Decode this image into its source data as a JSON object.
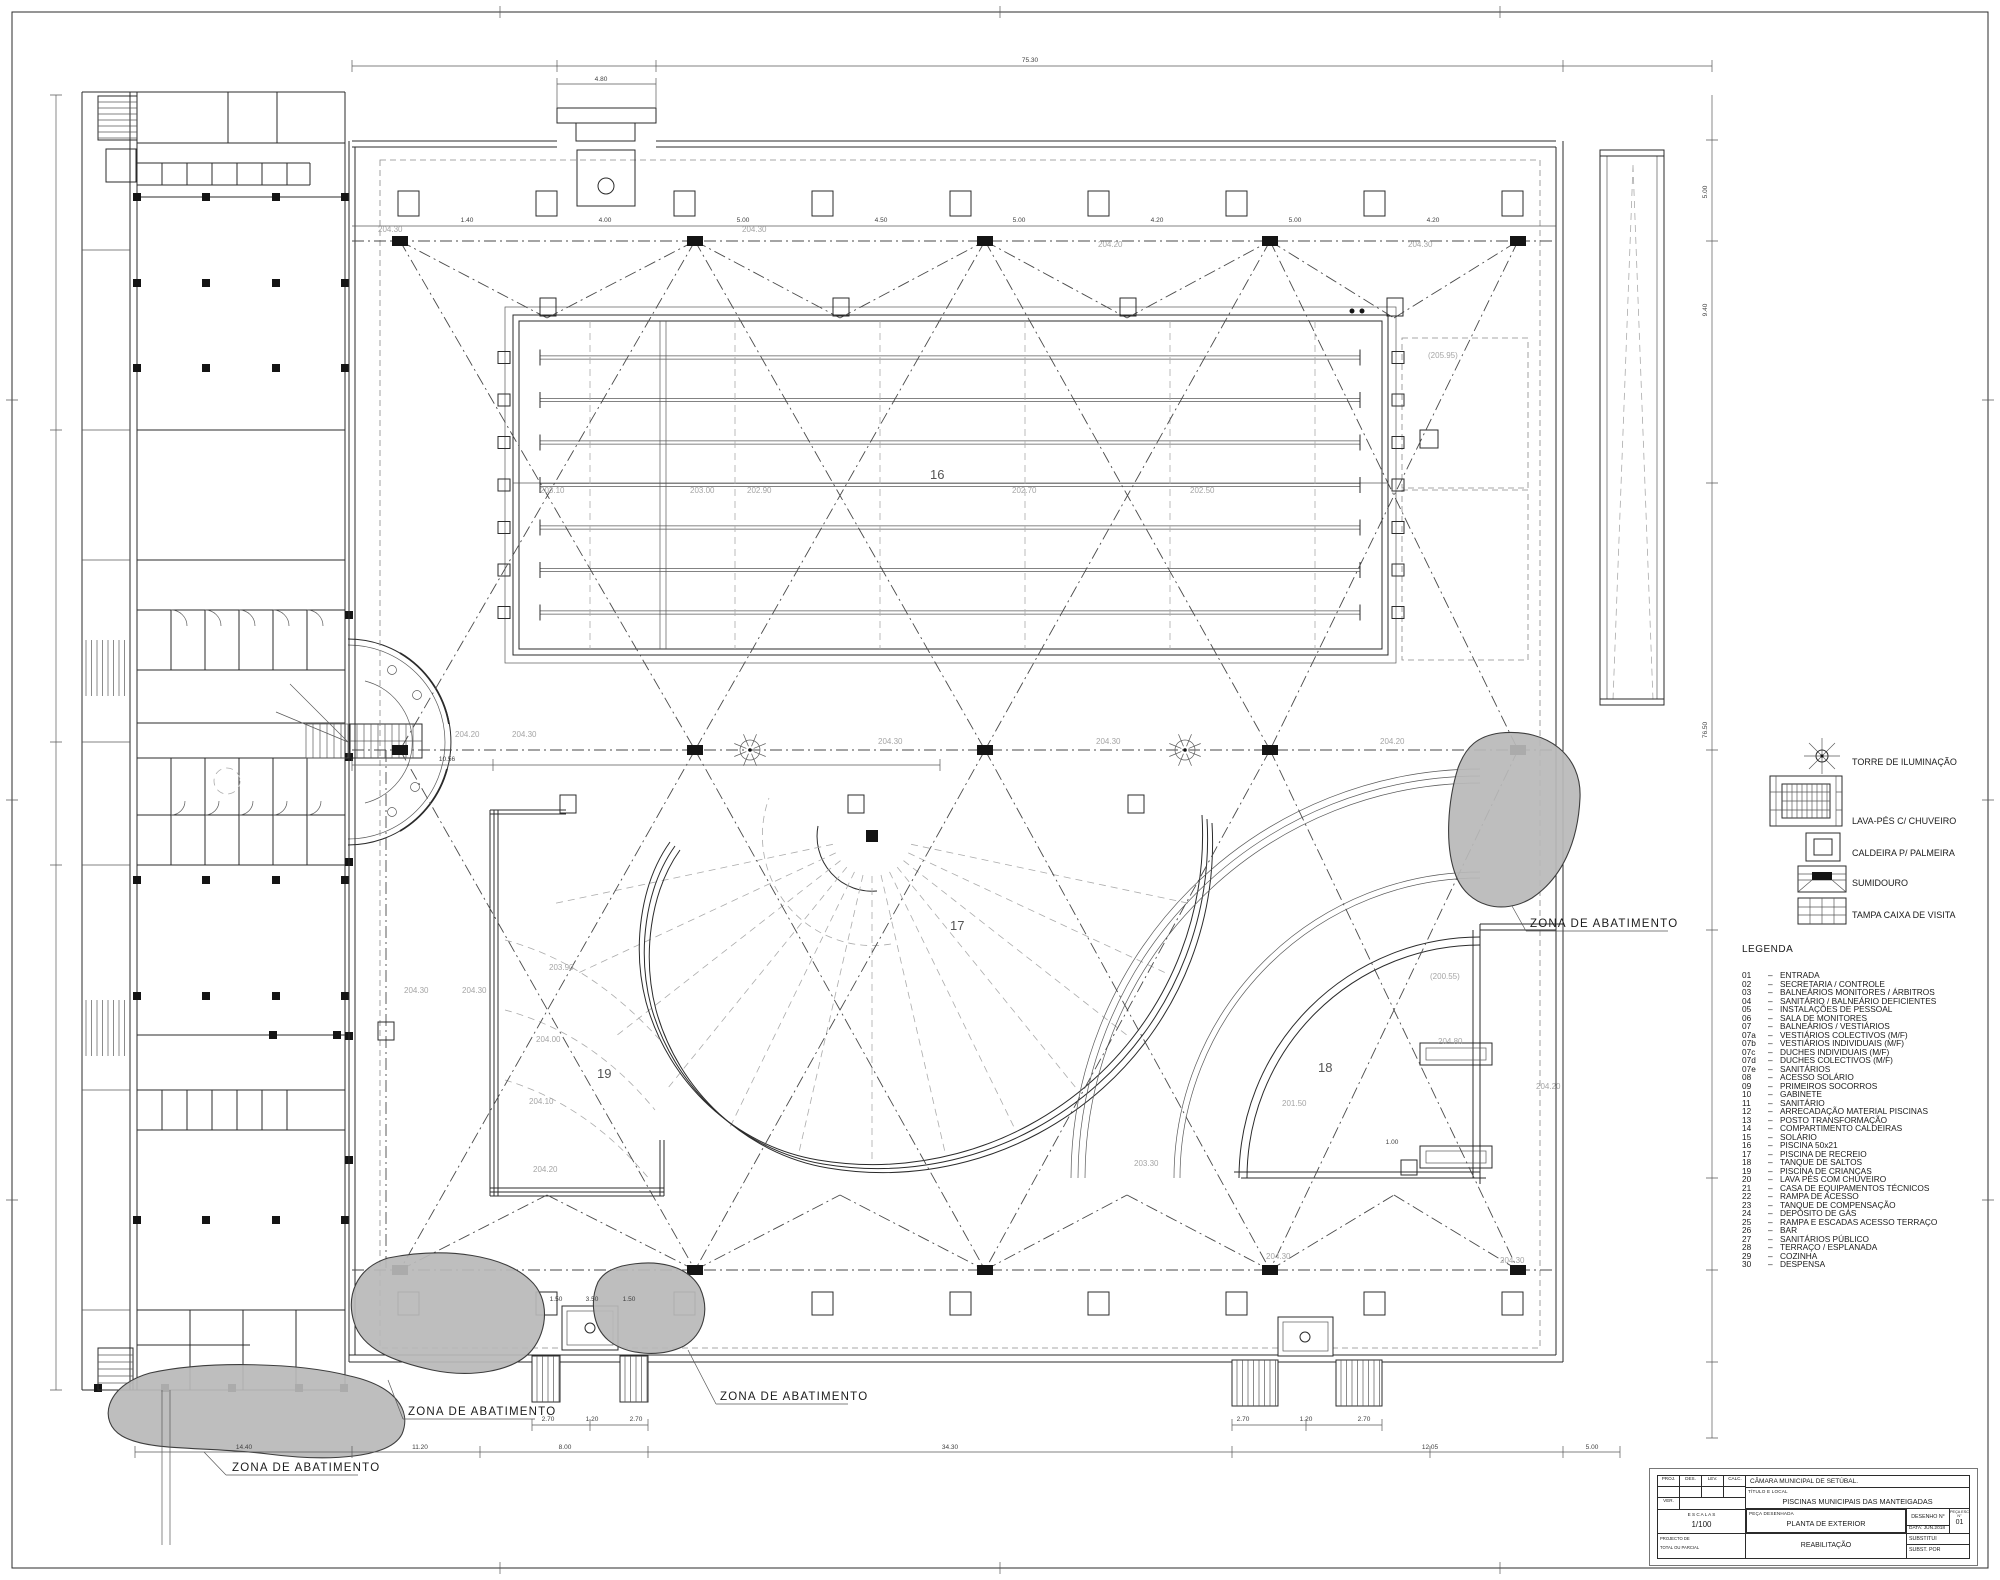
{
  "sheet": {
    "background": "#ffffff",
    "line_color": "#2b2b2b",
    "gray_text": "#a5a5a5",
    "blob_color": "#b9b9b9"
  },
  "zone_labels": [
    {
      "text": "ZONA DE ABATIMENTO",
      "x": 232,
      "y": 1471
    },
    {
      "text": "ZONA DE ABATIMENTO",
      "x": 408,
      "y": 1415
    },
    {
      "text": "ZONA DE ABATIMENTO",
      "x": 720,
      "y": 1400
    },
    {
      "text": "ZONA DE ABATIMENTO",
      "x": 1530,
      "y": 927
    }
  ],
  "area_labels": [
    {
      "text": "16",
      "x": 930,
      "y": 479
    },
    {
      "text": "17",
      "x": 950,
      "y": 930
    },
    {
      "text": "18",
      "x": 1318,
      "y": 1072
    },
    {
      "text": "19",
      "x": 597,
      "y": 1078
    }
  ],
  "elevation_labels": [
    {
      "text": "204.30",
      "x": 378,
      "y": 232
    },
    {
      "text": "204.30",
      "x": 742,
      "y": 232
    },
    {
      "text": "204.20",
      "x": 1098,
      "y": 247
    },
    {
      "text": "204.30",
      "x": 1408,
      "y": 247
    },
    {
      "text": "203.10",
      "x": 540,
      "y": 493
    },
    {
      "text": "203.00",
      "x": 690,
      "y": 493
    },
    {
      "text": "202.90",
      "x": 747,
      "y": 493
    },
    {
      "text": "202.70",
      "x": 1012,
      "y": 493
    },
    {
      "text": "202.50",
      "x": 1190,
      "y": 493
    },
    {
      "text": "204.20",
      "x": 455,
      "y": 737
    },
    {
      "text": "204.30",
      "x": 512,
      "y": 737
    },
    {
      "text": "204.30",
      "x": 878,
      "y": 744
    },
    {
      "text": "204.30",
      "x": 1096,
      "y": 744
    },
    {
      "text": "204.20",
      "x": 1380,
      "y": 744
    },
    {
      "text": "204.30",
      "x": 404,
      "y": 993
    },
    {
      "text": "204.30",
      "x": 462,
      "y": 993
    },
    {
      "text": "203.90",
      "x": 549,
      "y": 970
    },
    {
      "text": "204.00",
      "x": 536,
      "y": 1042
    },
    {
      "text": "204.10",
      "x": 529,
      "y": 1104
    },
    {
      "text": "204.20",
      "x": 533,
      "y": 1172
    },
    {
      "text": "201.50",
      "x": 1282,
      "y": 1106
    },
    {
      "text": "(205.95)",
      "x": 1428,
      "y": 358
    },
    {
      "text": "(200.55)",
      "x": 1430,
      "y": 979
    },
    {
      "text": "204.80",
      "x": 1438,
      "y": 1044
    },
    {
      "text": "204.20",
      "x": 1536,
      "y": 1089
    },
    {
      "text": "204.30",
      "x": 1500,
      "y": 1263
    },
    {
      "text": "204.30",
      "x": 1266,
      "y": 1259
    },
    {
      "text": "203.30",
      "x": 1134,
      "y": 1166
    }
  ],
  "dimension_labels": [
    {
      "text": "1.40",
      "x": 467,
      "y": 222
    },
    {
      "text": "4.00",
      "x": 605,
      "y": 222
    },
    {
      "text": "5.00",
      "x": 743,
      "y": 222
    },
    {
      "text": "4.50",
      "x": 881,
      "y": 222
    },
    {
      "text": "5.00",
      "x": 1019,
      "y": 222
    },
    {
      "text": "4.20",
      "x": 1157,
      "y": 222
    },
    {
      "text": "5.00",
      "x": 1295,
      "y": 222
    },
    {
      "text": "4.20",
      "x": 1433,
      "y": 222
    },
    {
      "text": "4.80",
      "x": 601,
      "y": 81
    },
    {
      "text": "75.30",
      "x": 1030,
      "y": 62
    },
    {
      "text": "10.56",
      "x": 447,
      "y": 761
    },
    {
      "text": "14.40",
      "x": 244,
      "y": 1449
    },
    {
      "text": "11.20",
      "x": 420,
      "y": 1449
    },
    {
      "text": "8.00",
      "x": 565,
      "y": 1449
    },
    {
      "text": "34.30",
      "x": 950,
      "y": 1449
    },
    {
      "text": "12.05",
      "x": 1430,
      "y": 1449
    },
    {
      "text": "5.00",
      "x": 1592,
      "y": 1449
    },
    {
      "text": "2.70",
      "x": 548,
      "y": 1421
    },
    {
      "text": "1.20",
      "x": 592,
      "y": 1421
    },
    {
      "text": "2.70",
      "x": 636,
      "y": 1421
    },
    {
      "text": "2.70",
      "x": 1243,
      "y": 1421
    },
    {
      "text": "1.20",
      "x": 1306,
      "y": 1421
    },
    {
      "text": "2.70",
      "x": 1364,
      "y": 1421
    },
    {
      "text": "1.50",
      "x": 556,
      "y": 1301
    },
    {
      "text": "3.50",
      "x": 592,
      "y": 1301
    },
    {
      "text": "1.50",
      "x": 629,
      "y": 1301
    },
    {
      "text": "1.00",
      "x": 1392,
      "y": 1144
    },
    {
      "text": "76.50",
      "x": 1707,
      "y": 730,
      "rot": -90
    },
    {
      "text": "5.00",
      "x": 1707,
      "y": 192,
      "rot": -90
    },
    {
      "text": "9.40",
      "x": 1707,
      "y": 310,
      "rot": -90
    }
  ],
  "symbols_legend": {
    "items": [
      {
        "icon": "light-tower-icon",
        "label": "TORRE DE ILUMINAÇÃO"
      },
      {
        "icon": "footbath-icon",
        "label": "LAVA-PÉS C/ CHUVEIRO"
      },
      {
        "icon": "palm-planter-icon",
        "label": "CALDEIRA P/ PALMEIRA"
      },
      {
        "icon": "drain-icon",
        "label": "SUMIDOURO"
      },
      {
        "icon": "manhole-cover-icon",
        "label": "TAMPA CAIXA DE VISITA"
      }
    ]
  },
  "legend": {
    "title": "LEGENDA",
    "items": [
      {
        "num": "01",
        "label": "ENTRADA"
      },
      {
        "num": "02",
        "label": "SECRETARIA / CONTROLE"
      },
      {
        "num": "03",
        "label": "BALNEÁRIOS MONITORES / ÁRBITROS"
      },
      {
        "num": "04",
        "label": "SANITÁRIO / BALNEÁRIO DEFICIENTES"
      },
      {
        "num": "05",
        "label": "INSTALAÇÕES DE PESSOAL"
      },
      {
        "num": "06",
        "label": "SALA DE MONITORES"
      },
      {
        "num": "07",
        "label": "BALNEÁRIOS / VESTIÁRIOS"
      },
      {
        "num": "07a",
        "label": "VESTIÁRIOS COLECTIVOS (M/F)"
      },
      {
        "num": "07b",
        "label": "VESTIÁRIOS INDIVIDUAIS (M/F)"
      },
      {
        "num": "07c",
        "label": "DUCHES INDIVIDUAIS (M/F)"
      },
      {
        "num": "07d",
        "label": "DUCHES COLECTIVOS (M/F)"
      },
      {
        "num": "07e",
        "label": "SANITÁRIOS"
      },
      {
        "num": "08",
        "label": "ACESSO SOLÁRIO"
      },
      {
        "num": "09",
        "label": "PRIMEIROS SOCORROS"
      },
      {
        "num": "10",
        "label": "GABINETE"
      },
      {
        "num": "11",
        "label": "SANITÁRIO"
      },
      {
        "num": "12",
        "label": "ARRECADAÇÃO MATERIAL PISCINAS"
      },
      {
        "num": "13",
        "label": "POSTO TRANSFORMAÇÃO"
      },
      {
        "num": "14",
        "label": "COMPARTIMENTO CALDEIRAS"
      },
      {
        "num": "15",
        "label": "SOLÁRIO"
      },
      {
        "num": "16",
        "label": "PISCINA 50x21"
      },
      {
        "num": "17",
        "label": "PISCINA DE RECREIO"
      },
      {
        "num": "18",
        "label": "TANQUE DE SALTOS"
      },
      {
        "num": "19",
        "label": "PISCINA DE CRIANÇAS"
      },
      {
        "num": "20",
        "label": "LAVA PÉS COM CHUVEIRO"
      },
      {
        "num": "21",
        "label": "CASA DE EQUIPAMENTOS TÉCNICOS"
      },
      {
        "num": "22",
        "label": "RAMPA DE ACESSO"
      },
      {
        "num": "23",
        "label": "TANQUE DE COMPENSAÇÃO"
      },
      {
        "num": "24",
        "label": "DEPÓSITO DE GÁS"
      },
      {
        "num": "25",
        "label": "RAMPA E ESCADAS ACESSO TERRAÇO"
      },
      {
        "num": "26",
        "label": "BAR"
      },
      {
        "num": "27",
        "label": "SANITÁRIOS PÚBLICO"
      },
      {
        "num": "28",
        "label": "TERRAÇO / ESPLANADA"
      },
      {
        "num": "29",
        "label": "COZINHA"
      },
      {
        "num": "30",
        "label": "DESPENSA"
      }
    ]
  },
  "title_block": {
    "org": "CÂMARA MUNICIPAL DE SETÚBAL.",
    "title_label": "TÍTULO E LOCAL",
    "project_title": "PISCINAS MUNICIPAIS DAS MANTEIGADAS",
    "cols": {
      "c1": "PROJ.",
      "c2": "DES.",
      "c3": "LEV.",
      "c4": "CALC."
    },
    "ver_label": "VER.",
    "scale_label": "E S C A L A S",
    "scale_value": "1/100",
    "piece_label": "PEÇA DESENHADA",
    "piece_value": "PLANTA DE EXTERIOR",
    "drawing_no_label": "DESENHO N°",
    "sheet_no_label": "PEÇA ESC N°",
    "sheet_no_value": "01",
    "date_label": "DATA:",
    "date_value": "JUN.2018",
    "substitui_label": "SUBSTITUI",
    "subst_por_label": "SUBST. POR",
    "phase_value": "REABILITAÇÃO",
    "left_label_1": "PROJECTO DE",
    "left_label_2": "TOTAL OU PARCIAL"
  }
}
